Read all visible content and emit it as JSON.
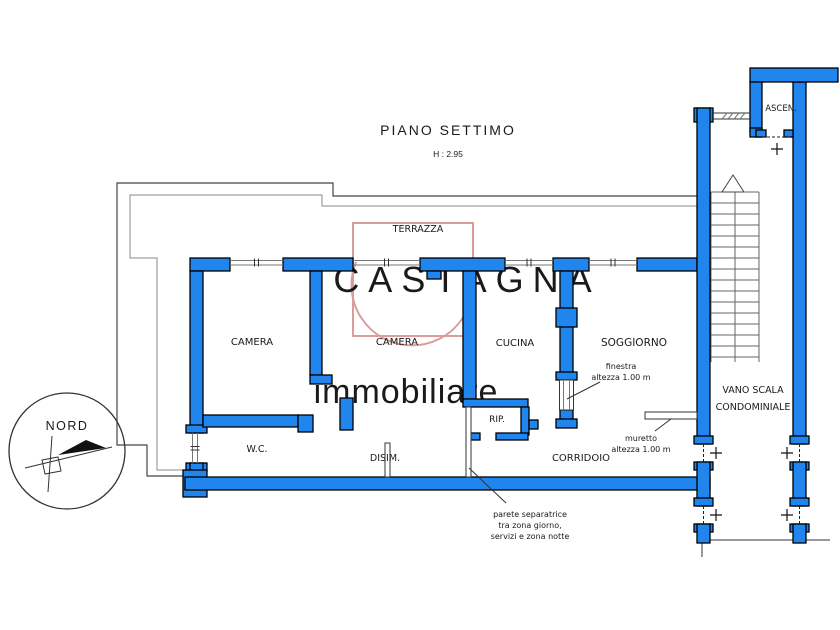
{
  "title": {
    "text": "PIANO SETTIMO",
    "height_note": "H : 2.95"
  },
  "watermark": {
    "brand": "CASTAGNA",
    "tagline": "immobiliare"
  },
  "compass": {
    "label": "NORD"
  },
  "rooms": {
    "terrazza": "TERRAZZA",
    "camera1": "CAMERA",
    "camera2": "CAMERA",
    "cucina": "CUCINA",
    "soggiorno": "SOGGIORNO",
    "wc": "W.C.",
    "disimpegno": "DISIM.",
    "ripostiglio": "RIP.",
    "corridoio": "CORRIDOIO",
    "vano_scala_line1": "VANO SCALA",
    "vano_scala_line2": "CONDOMINIALE",
    "ascensore": "ASCEN."
  },
  "annotations": {
    "finestra_line1": "finestra",
    "finestra_line2": "altezza 1.00 m",
    "muretto_line1": "muretto",
    "muretto_line2": "altezza 1.00 m",
    "parete_line1": "parete separatrice",
    "parete_line2": "tra zona giorno,",
    "parete_line3": "servizi e zona notte"
  },
  "palette": {
    "wall_fill": "#2085ec",
    "wall_stroke": "#000000",
    "thin_line": "#555555",
    "watermark_pink": "#dc9c9c",
    "watermark_gray": "#b5b5b5",
    "watermark_gray_light": "#c6c6c6",
    "label_color": "#1a1a1a"
  }
}
